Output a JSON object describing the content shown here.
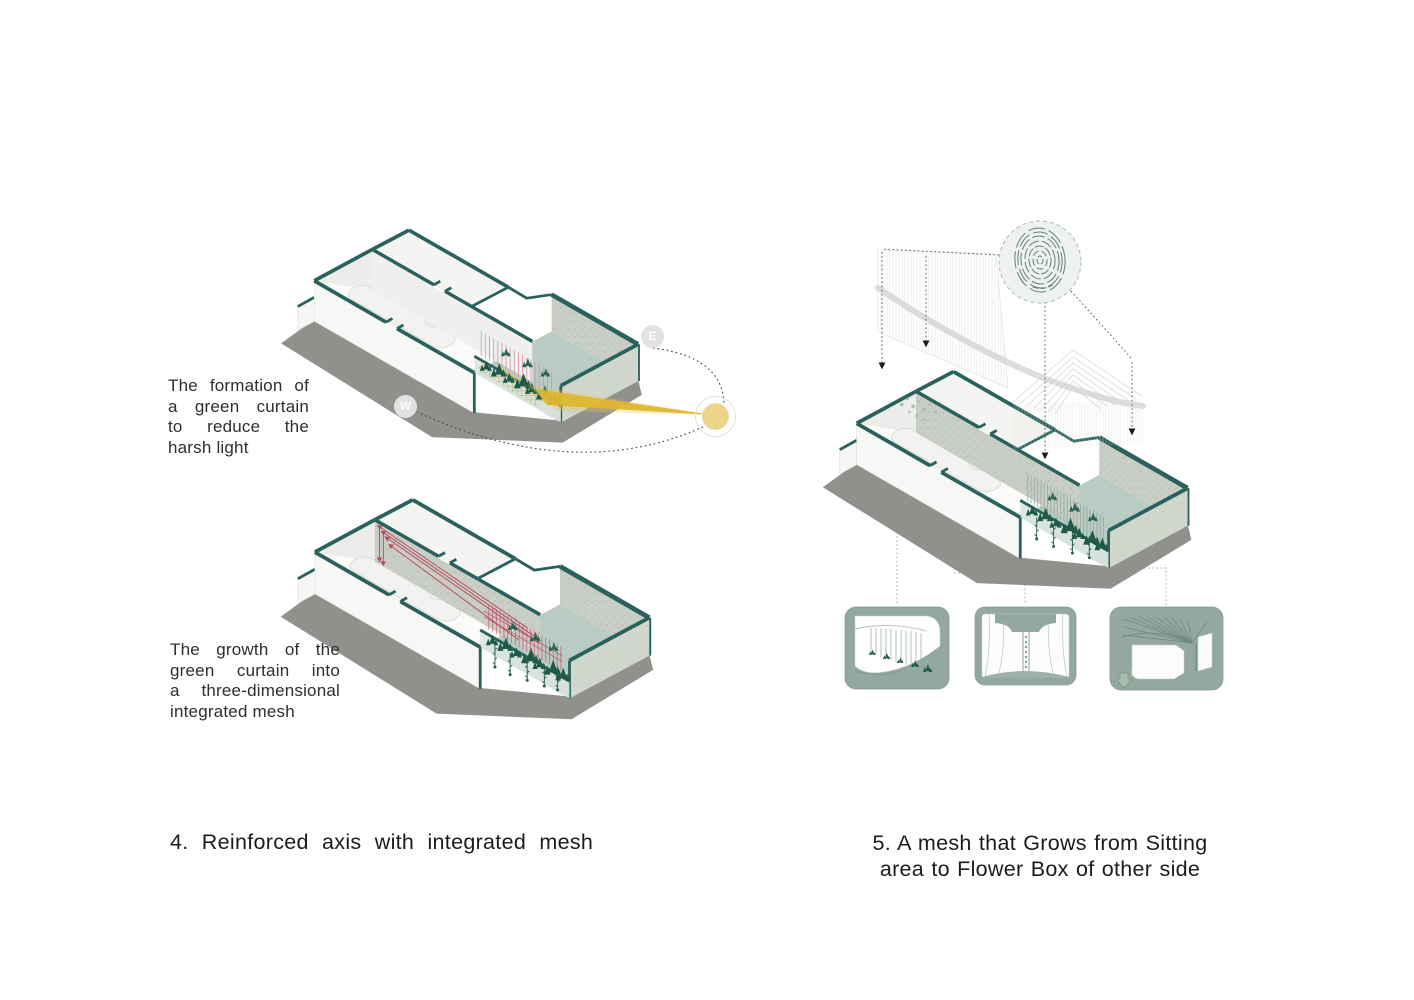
{
  "left_column": {
    "note_formation": [
      "The formation of",
      "a green curtain",
      "to reduce the",
      "harsh light"
    ],
    "note_growth": [
      "The growth of the",
      "green curtain into",
      "a three-dimensional",
      "integrated mesh"
    ],
    "caption_fig4": "4. Reinforced axis with integrated mesh"
  },
  "right_column": {
    "caption_fig5_lines": [
      "5. A mesh that Grows from Sitting",
      "area to Flower Box of other side"
    ]
  },
  "sun_path_diagram": {
    "east_marker": "E",
    "west_marker": "W"
  },
  "colors": {
    "wall_teal": "#2a615d",
    "floor_sage": "#b9cbc3",
    "frame_sage": "#93a89e",
    "plant_green": "#1f5a49",
    "mesh_pink": "#cf93a1",
    "growth_red": "#b84a5e",
    "sun_yellow": "#e8c84a",
    "shadow_gray": "#90908d",
    "concrete_gray": "#c9cfc7",
    "text_dark": "#2d2d2d"
  }
}
